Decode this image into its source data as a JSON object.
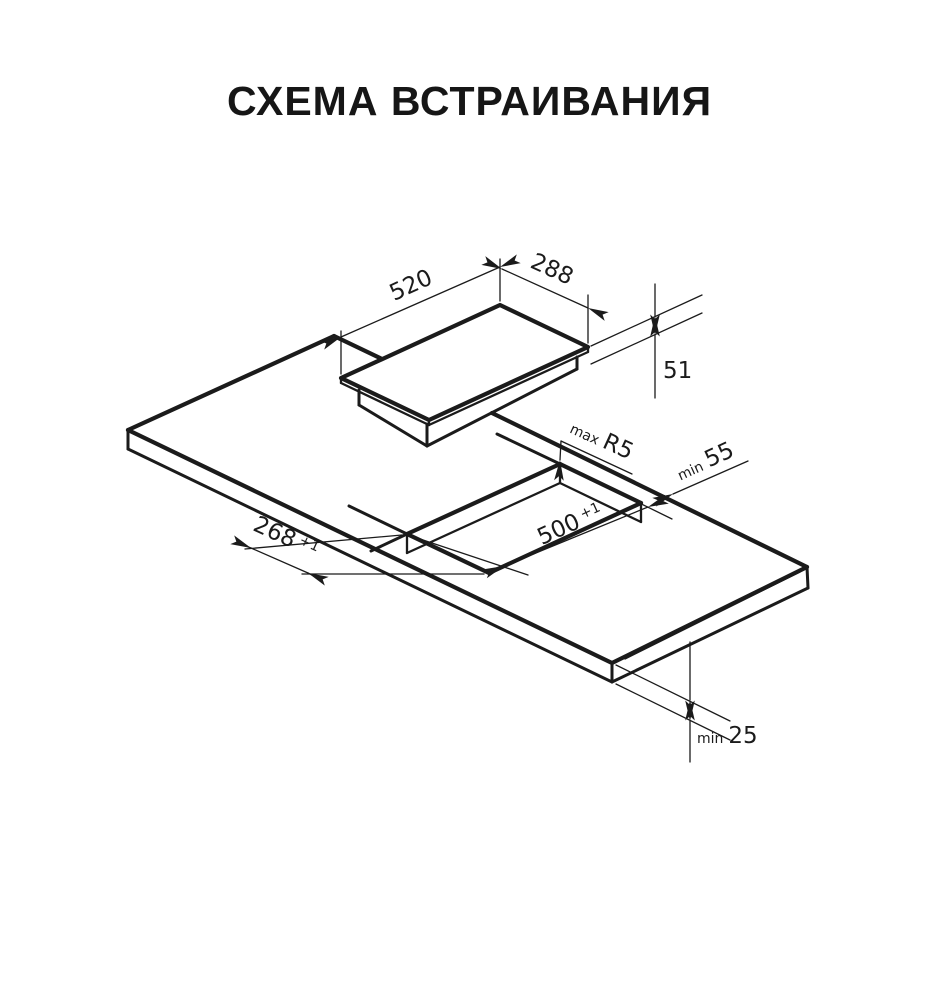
{
  "title": "СХЕМА ВСТРАИВАНИЯ",
  "diagram": {
    "hob": {
      "length": "520",
      "width": "288",
      "height": "51"
    },
    "cutout": {
      "length": "500",
      "length_tol": "+1",
      "width": "268",
      "width_tol": "+1",
      "radius_prefix": "max",
      "radius": "R5",
      "back_clearance_prefix": "min",
      "back_clearance": "55"
    },
    "worktop": {
      "thickness_prefix": "min",
      "thickness": "25"
    }
  },
  "colors": {
    "line": "#1b1b1b",
    "background": "#ffffff"
  }
}
